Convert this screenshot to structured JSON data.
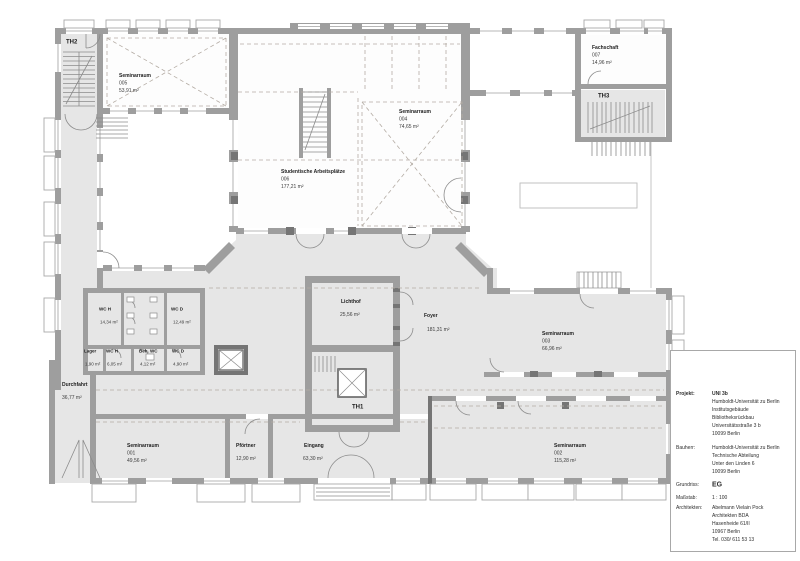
{
  "plan": {
    "rooms": {
      "th2": {
        "label": "TH2"
      },
      "th3": {
        "label": "TH3"
      },
      "th1": {
        "label": "TH1"
      },
      "seminarraum_005": {
        "name": "Seminarraum",
        "number": "005",
        "area": "53,91 m²"
      },
      "seminarraum_004": {
        "name": "Seminarraum",
        "number": "004",
        "area": "74,65 m²"
      },
      "fachschaft_007": {
        "name": "Fachschaft",
        "number": "007",
        "area": "14,96 m²"
      },
      "studentische_006": {
        "name": "Studentische Arbeitsplätze",
        "number": "006",
        "area": "177,21 m²"
      },
      "lichthof": {
        "name": "Lichthof",
        "area": "25,56 m²"
      },
      "foyer": {
        "name": "Foyer",
        "area": "181,31 m²"
      },
      "seminarraum_003": {
        "name": "Seminarraum",
        "number": "003",
        "area": "66,96 m²"
      },
      "wc_h_gross": {
        "name": "WC H",
        "area": "14,34 m²"
      },
      "wc_d_gross": {
        "name": "WC D",
        "area": "12,49 m²"
      },
      "lager": {
        "name": "Lager",
        "area": "1,90 m²"
      },
      "wc_h_klein": {
        "name": "WC H",
        "area": "6,05 m²"
      },
      "beh_wc": {
        "name": "Beh. WC",
        "area": "4,12 m²"
      },
      "wc_d_klein": {
        "name": "WC D",
        "area": "4,90 m²"
      },
      "durchfahrt": {
        "name": "Durchfahrt",
        "area": "36,77 m²"
      },
      "seminarraum_001": {
        "name": "Seminarraum",
        "number": "001",
        "area": "49,56 m²"
      },
      "pfoertner": {
        "name": "Pförtner",
        "area": "12,90 m²"
      },
      "eingang": {
        "name": "Eingang",
        "area": "63,30 m²"
      },
      "seminarraum_002": {
        "name": "Seminarraum",
        "number": "002",
        "area": "115,28 m²"
      }
    }
  },
  "title_block": {
    "north_label": "N",
    "projekt_label": "Projekt:",
    "projekt": [
      "UNI 3b",
      "Humboldt-Universität zu Berlin",
      "Institutsgebäude",
      "Bibliotheksrückbau",
      "Universitätsstraße 3 b",
      "10099 Berlin"
    ],
    "bauherr_label": "Bauherr:",
    "bauherr": [
      "Humboldt-Universität zu Berlin",
      "Technische Abteilung",
      "Unter den Linden 6",
      "10099 Berlin"
    ],
    "grundriss_label": "Grundriss:",
    "grundriss_value": "EG",
    "massstab_label": "Maßstab:",
    "massstab_value": "1 : 100",
    "architekten_label": "Architekten:",
    "architekten": [
      "Abelmann Vielain Pock",
      "Architekten BDA",
      "Hasenheide 61/II",
      "10967 Berlin",
      "Tel. 030/ 611 53 13"
    ],
    "logo": [
      "a",
      "v",
      "p"
    ]
  },
  "colors": {
    "wall": "#9e9e9e",
    "wall_dark": "#757575",
    "floor": "#e6e6e6",
    "dash": "#b4aca4"
  }
}
